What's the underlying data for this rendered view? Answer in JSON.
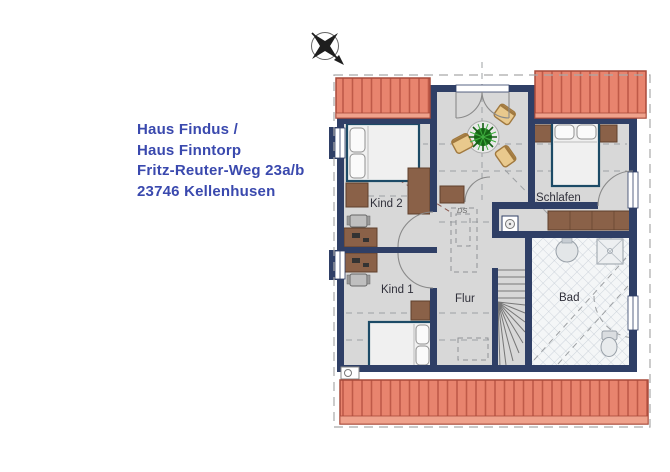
{
  "title": {
    "line1": "Haus Findus /",
    "line2": "Haus Finntorp",
    "line3": "Fritz-Reuter-Weg 23a/b",
    "line4": "23746 Kellenhusen"
  },
  "floorplan": {
    "rooms": [
      {
        "id": "kind2",
        "label": "Kind 2"
      },
      {
        "id": "schlafen",
        "label": "Schlafen"
      },
      {
        "id": "kind1",
        "label": "Kind 1"
      },
      {
        "id": "flur",
        "label": "Flur"
      },
      {
        "id": "bad",
        "label": "Bad"
      }
    ],
    "annotations": {
      "ds": "DS"
    }
  },
  "icons": {
    "compass": "compass-rose-icon",
    "north_arrow": "north-arrow"
  },
  "colors": {
    "address_text": "#3A49AE",
    "roof": "#E8846E",
    "roof_stripe": "#BF5A48",
    "roof_edge": "#A84A3A",
    "wall": "#2F3F66",
    "floor": "#D8D8D8",
    "bath_tile": "#F4F6F7",
    "furniture_wood": "#8A6148",
    "chair_tan": "#E9C98D",
    "plant_green": "#1C741C",
    "bed_frame": "#1C4A66",
    "label_text": "#30303A"
  }
}
